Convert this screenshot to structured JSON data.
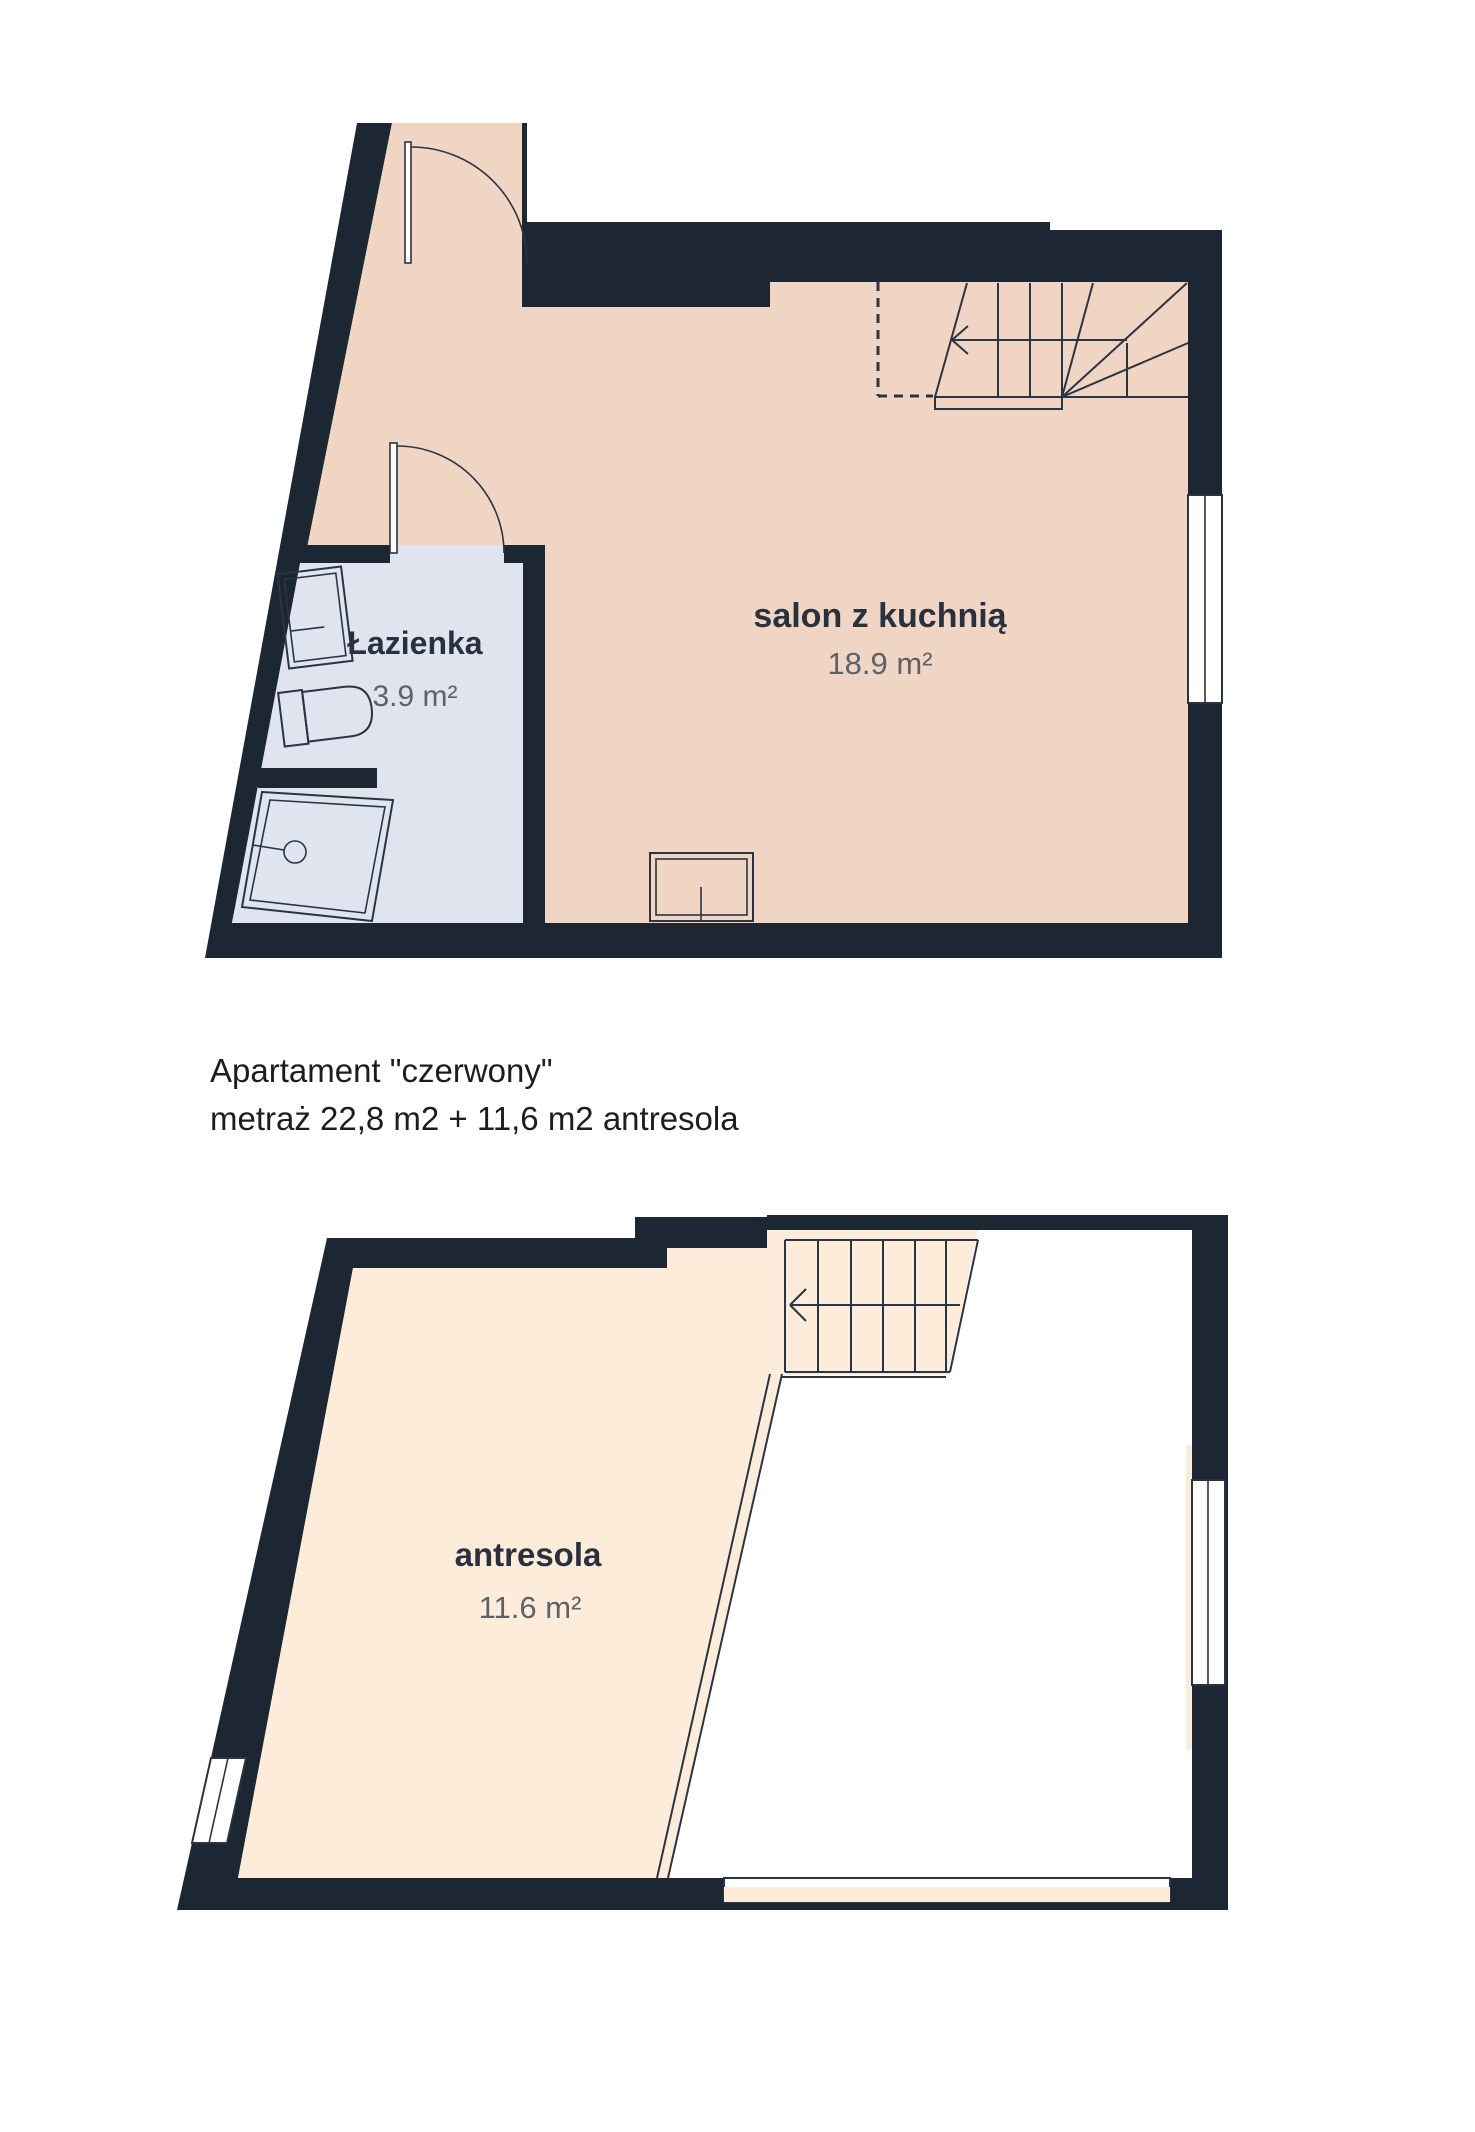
{
  "caption": {
    "line1": "Apartament \"czerwony\"",
    "line2": "metraż 22,8 m2 + 11,6 m2 antresola"
  },
  "plans": {
    "upper": {
      "name": "upper-floor-plan",
      "rooms": [
        {
          "name": "salon z kuchnią",
          "area": "18.9 m²"
        },
        {
          "name": "Łazienka",
          "area": "3.9 m²"
        }
      ],
      "features": [
        "entry-door",
        "bathroom-door",
        "winder-staircase",
        "window-right",
        "kitchen-unit",
        "sink",
        "toilet",
        "shower"
      ]
    },
    "lower": {
      "name": "mezzanine-plan",
      "rooms": [
        {
          "name": "antresola",
          "area": "11.6 m²"
        }
      ],
      "features": [
        "staircase",
        "void-open-to-below",
        "window-right",
        "window-left",
        "window-bottom"
      ]
    }
  },
  "colors": {
    "wall": "#1d2633",
    "floor_upper": "#f0d5c4",
    "floor_lower": "#fdecd9",
    "floor_bathroom": "#dfe4ee",
    "label_navy": "#29313f",
    "label_gray": "#5d6269",
    "caption_text": "#1d1d1f",
    "background": "#ffffff"
  }
}
